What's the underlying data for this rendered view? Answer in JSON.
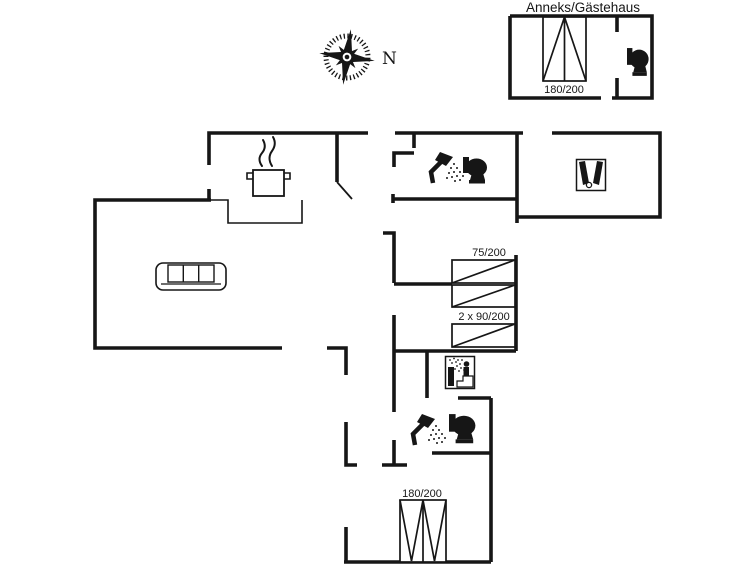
{
  "colors": {
    "ink": "#161616",
    "paper": "#ffffff"
  },
  "compass": {
    "north_label": "N"
  },
  "annex": {
    "title": "Anneks/Gästehaus",
    "bed_label": "180/200"
  },
  "main_house": {
    "rooms": {
      "bedroom_east": {
        "bed_label": "75/200"
      },
      "bedroom_east_south": {
        "bed_label": "2 x 90/200"
      },
      "bedroom_south": {
        "bed_label": "180/200"
      }
    }
  },
  "icons": {
    "annex": [
      "toilet"
    ],
    "kitchen": [
      "cooking-pot-steam"
    ],
    "living_room": [
      "sofa"
    ],
    "bathroom_north": [
      "shower",
      "toilet"
    ],
    "east_room": [
      "bottles"
    ],
    "utility_room": [
      "sauna"
    ],
    "bathroom_south": [
      "shower",
      "toilet"
    ],
    "site": [
      "compass-rose"
    ]
  }
}
